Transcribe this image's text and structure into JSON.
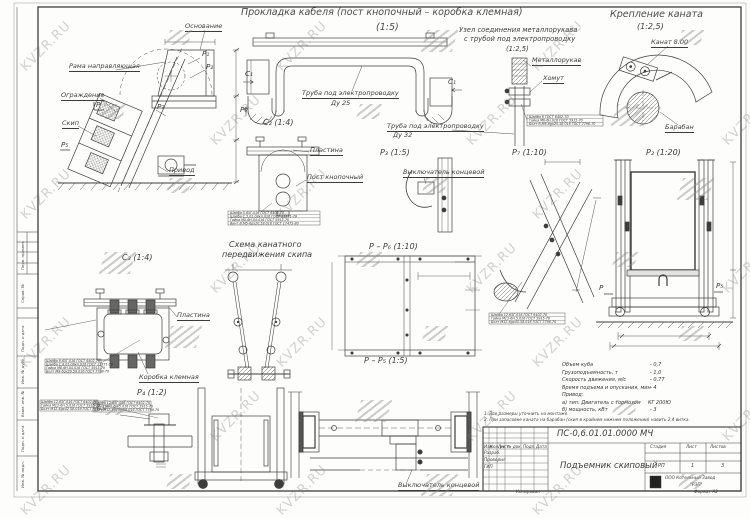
{
  "watermark": {
    "text": "KVZR.RU"
  },
  "titles": {
    "cable": {
      "title": "Прокладка кабеля (пост кнопочный – коробка клемная)",
      "scale": "(1:5)"
    },
    "sleeve": {
      "line1": "Узел соединения металлорукава",
      "line2": "с трубой под электропроводку",
      "scale": "(1:2,5)"
    },
    "rope": {
      "title": "Крепление каната",
      "scale": "(1:2,5)"
    },
    "scheme": {
      "line1": "Схема канатного",
      "line2": "передвижения скипа"
    }
  },
  "view_markers": {
    "c1": "C₁",
    "c2": "C₂ (1:4)",
    "c3": "C₃ (1:4)",
    "p2": "P₂ (1:20)",
    "p3": "P₃ (1:5)",
    "p4": "P₄ (1:2)",
    "p7": "P₇ (1:10)",
    "pp5": "P – P₅ (1:5)",
    "pp6": "P – P₆ (1:10)"
  },
  "markers": {
    "p1": "P₁",
    "p2": "P₂",
    "p7": "P₇",
    "p": "P",
    "p5": "P₅",
    "p6": "P₆"
  },
  "labels": {
    "osnovanie": "Основание",
    "rama": "Рама направляющая",
    "ograzhdenie": "Ограждение",
    "skip": "Скип",
    "privod": "Привод",
    "truba25": "Труба под электропроводку",
    "du25": "Ду 25",
    "truba32": "Труба под электропроводку",
    "du32": "Ду 32",
    "metallorukav": "Металлорукав",
    "khomut": "Хомут",
    "kanat": "Канат 8.00",
    "baraban": "Барабан",
    "plastina": "Пластина",
    "post": "Пост кнопочный",
    "vykl": "Выключатель концевой",
    "korobka": "Коробка клемная"
  },
  "fasteners": {
    "m6": [
      "Шайба 6 ГОСТ 6402-70",
      "Гайка М6-6Н.016 ГОСТ 5915-70",
      "Болт В.М6-6gх25.58.016 ГОСТ 7796-70"
    ],
    "m5": [
      "Шайба 5.65Г.016 ГОСТ 6402-70",
      "Шайба С.5.01.08кп.016 ГОСТ 11371-78",
      "Гайка М5-6Н.04.016 ГОСТ 5915-70",
      "Винт В.М5-6gх20.58.016 ГОСТ 17475-80"
    ],
    "m8": [
      "Шайба 8.65Г.016 ГОСТ 6402-70",
      "Шайба С.8.01.08кп.016 ГОСТ 11371-78",
      "Гайка М8-6Н.04.016 ГОСТ 5915-70",
      "Болт М8-6gх20.58.016 ГОСТ 7798-70"
    ],
    "m12a": [
      "Шайба 12.65Г.016 ГОСТ 6402-70",
      "Гайка М12-6Н.5.016 ГОСТ 5915-70",
      "Болт М12-6gх42.58.016 ГОСТ 7798-70"
    ],
    "m12b": [
      "Шайба 12.65Г.016 ГОСТ 6402-70",
      "Гайка М12-6Н.5.016 ГОСТ 5915-70",
      "Болт М12-6gх45.58.016 ГОСТ 7798-70"
    ],
    "m12c": [
      "Шайба 12.65Г.016 ГОСТ 6402-70",
      "Гайка М12-6Н.5.016 ГОСТ 5915-70",
      "Болт М12-6gх45.58.016 ГОСТ 7798-70"
    ]
  },
  "specs": {
    "rows": [
      {
        "label": "Объем куба",
        "value": "- 0,7"
      },
      {
        "label": "Грузоподъемность, т",
        "value": "- 1,0"
      },
      {
        "label": "Скорость движения, м/с",
        "value": "- 0,77"
      },
      {
        "label": "Время подъема и опускания, мин",
        "value": "- 4"
      },
      {
        "label": "Привод:",
        "value": ""
      },
      {
        "label": "а) тип: Двигатель с тормозом",
        "value": "КГ 200Ю"
      },
      {
        "label": "б) мощность, кВт",
        "value": "- 3"
      }
    ]
  },
  "notes": [
    "1. Все размеры уточнить на монтаже.",
    "2. При запасовке каната на барабан (скип в крайнем нижнем положении) навить 2,4 витка."
  ],
  "title_block": {
    "doc_number": "ПС-0,6.01.01.0000 МЧ",
    "title": "Подъемник скиповый",
    "stage_label": "Стадия",
    "sheet_label": "Лист",
    "sheets_label": "Листов",
    "stage": "РП",
    "sheet": "1",
    "sheets": "3",
    "company_line1": "ООО Котельный Завод",
    "company_line2": "\"РЭП\"",
    "rev_headers": [
      "Изм",
      "Кол.уч",
      "Лист",
      "№ док.",
      "Подп.",
      "Дата"
    ],
    "row_labels": [
      "Разраб.",
      "Проверил",
      "ГИП"
    ],
    "copied": "Копировал",
    "format": "Формат А2"
  },
  "side_strip": [
    "Перв. примен.",
    "Справ. №",
    "Подп. и дата",
    "Инв. № дубл.",
    "Взам. инв. №",
    "Подп. и дата",
    "Инв. № подл."
  ]
}
